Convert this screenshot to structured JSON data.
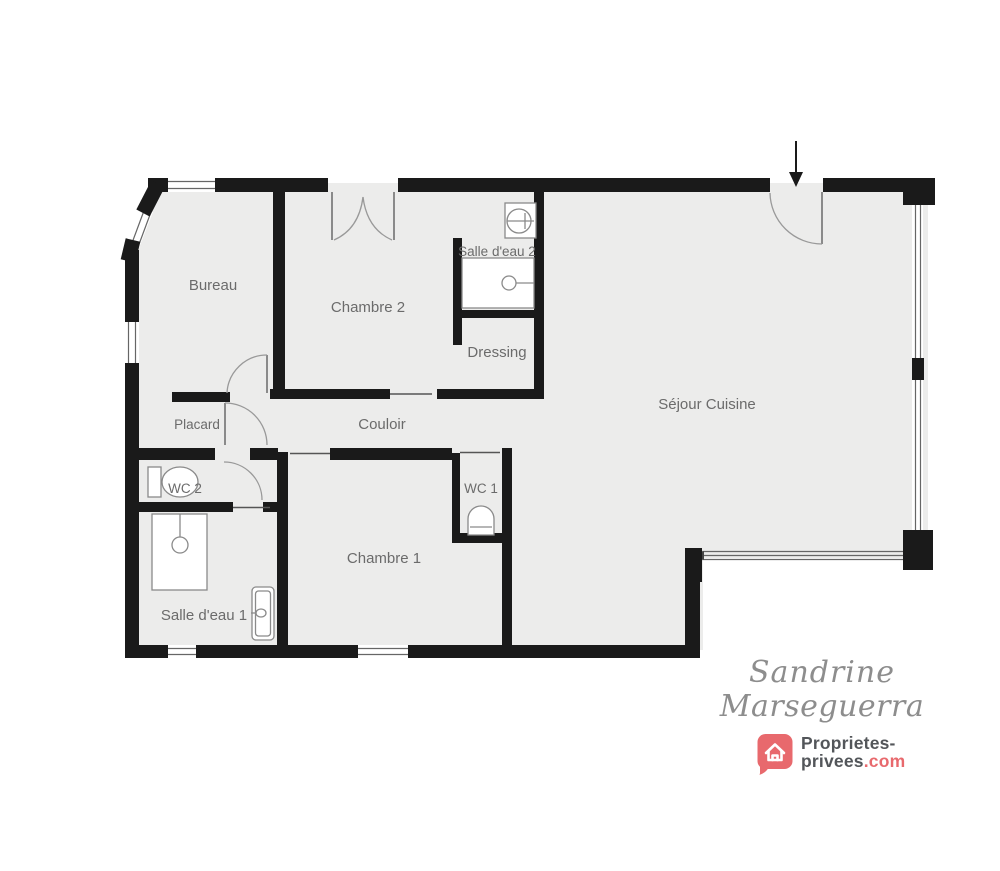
{
  "plan": {
    "rooms": [
      {
        "id": "bureau",
        "label": "Bureau"
      },
      {
        "id": "chambre-2",
        "label": "Chambre 2"
      },
      {
        "id": "salle-deau-2",
        "label": "Salle d'eau 2"
      },
      {
        "id": "dressing",
        "label": "Dressing"
      },
      {
        "id": "placard",
        "label": "Placard"
      },
      {
        "id": "couloir",
        "label": "Couloir"
      },
      {
        "id": "wc-2",
        "label": "WC 2"
      },
      {
        "id": "wc-1",
        "label": "WC 1"
      },
      {
        "id": "chambre-1",
        "label": "Chambre 1"
      },
      {
        "id": "salle-deau-1",
        "label": "Salle d'eau 1"
      },
      {
        "id": "sejour-cuisine",
        "label": "Séjour Cuisine"
      }
    ],
    "icons": {
      "entrance-arrow-icon": "down-arrow marking main entrance",
      "toilet-icon": "svg toilet symbol (WC 1, WC 2)",
      "shower-icon": "svg shower tray with drain (salle d'eau 1 & 2)",
      "sink-icon": "svg round basin with tap cross (salle d'eau 2)",
      "vanity-icon": "svg narrow washbasin unit (salle d'eau 1)",
      "door-swing-arc": "quarter-circle door swings",
      "window": "double thin lines in wall openings"
    },
    "colors": {
      "floor": "#ececeb",
      "wall": "#1a1a1a",
      "label_text": "#6b6b6b",
      "fixture_line": "#8a8a8a"
    }
  },
  "branding": {
    "agent_signature": {
      "line1": "Sandrine",
      "line2": "Marseguerra"
    },
    "logo": {
      "line1": "Proprietes-",
      "name": "privees",
      "tld": ".com"
    },
    "colors": {
      "brand_pink": "#e8696d",
      "brand_dark": "#53565a",
      "signature_gray": "#8d8d8d"
    }
  }
}
